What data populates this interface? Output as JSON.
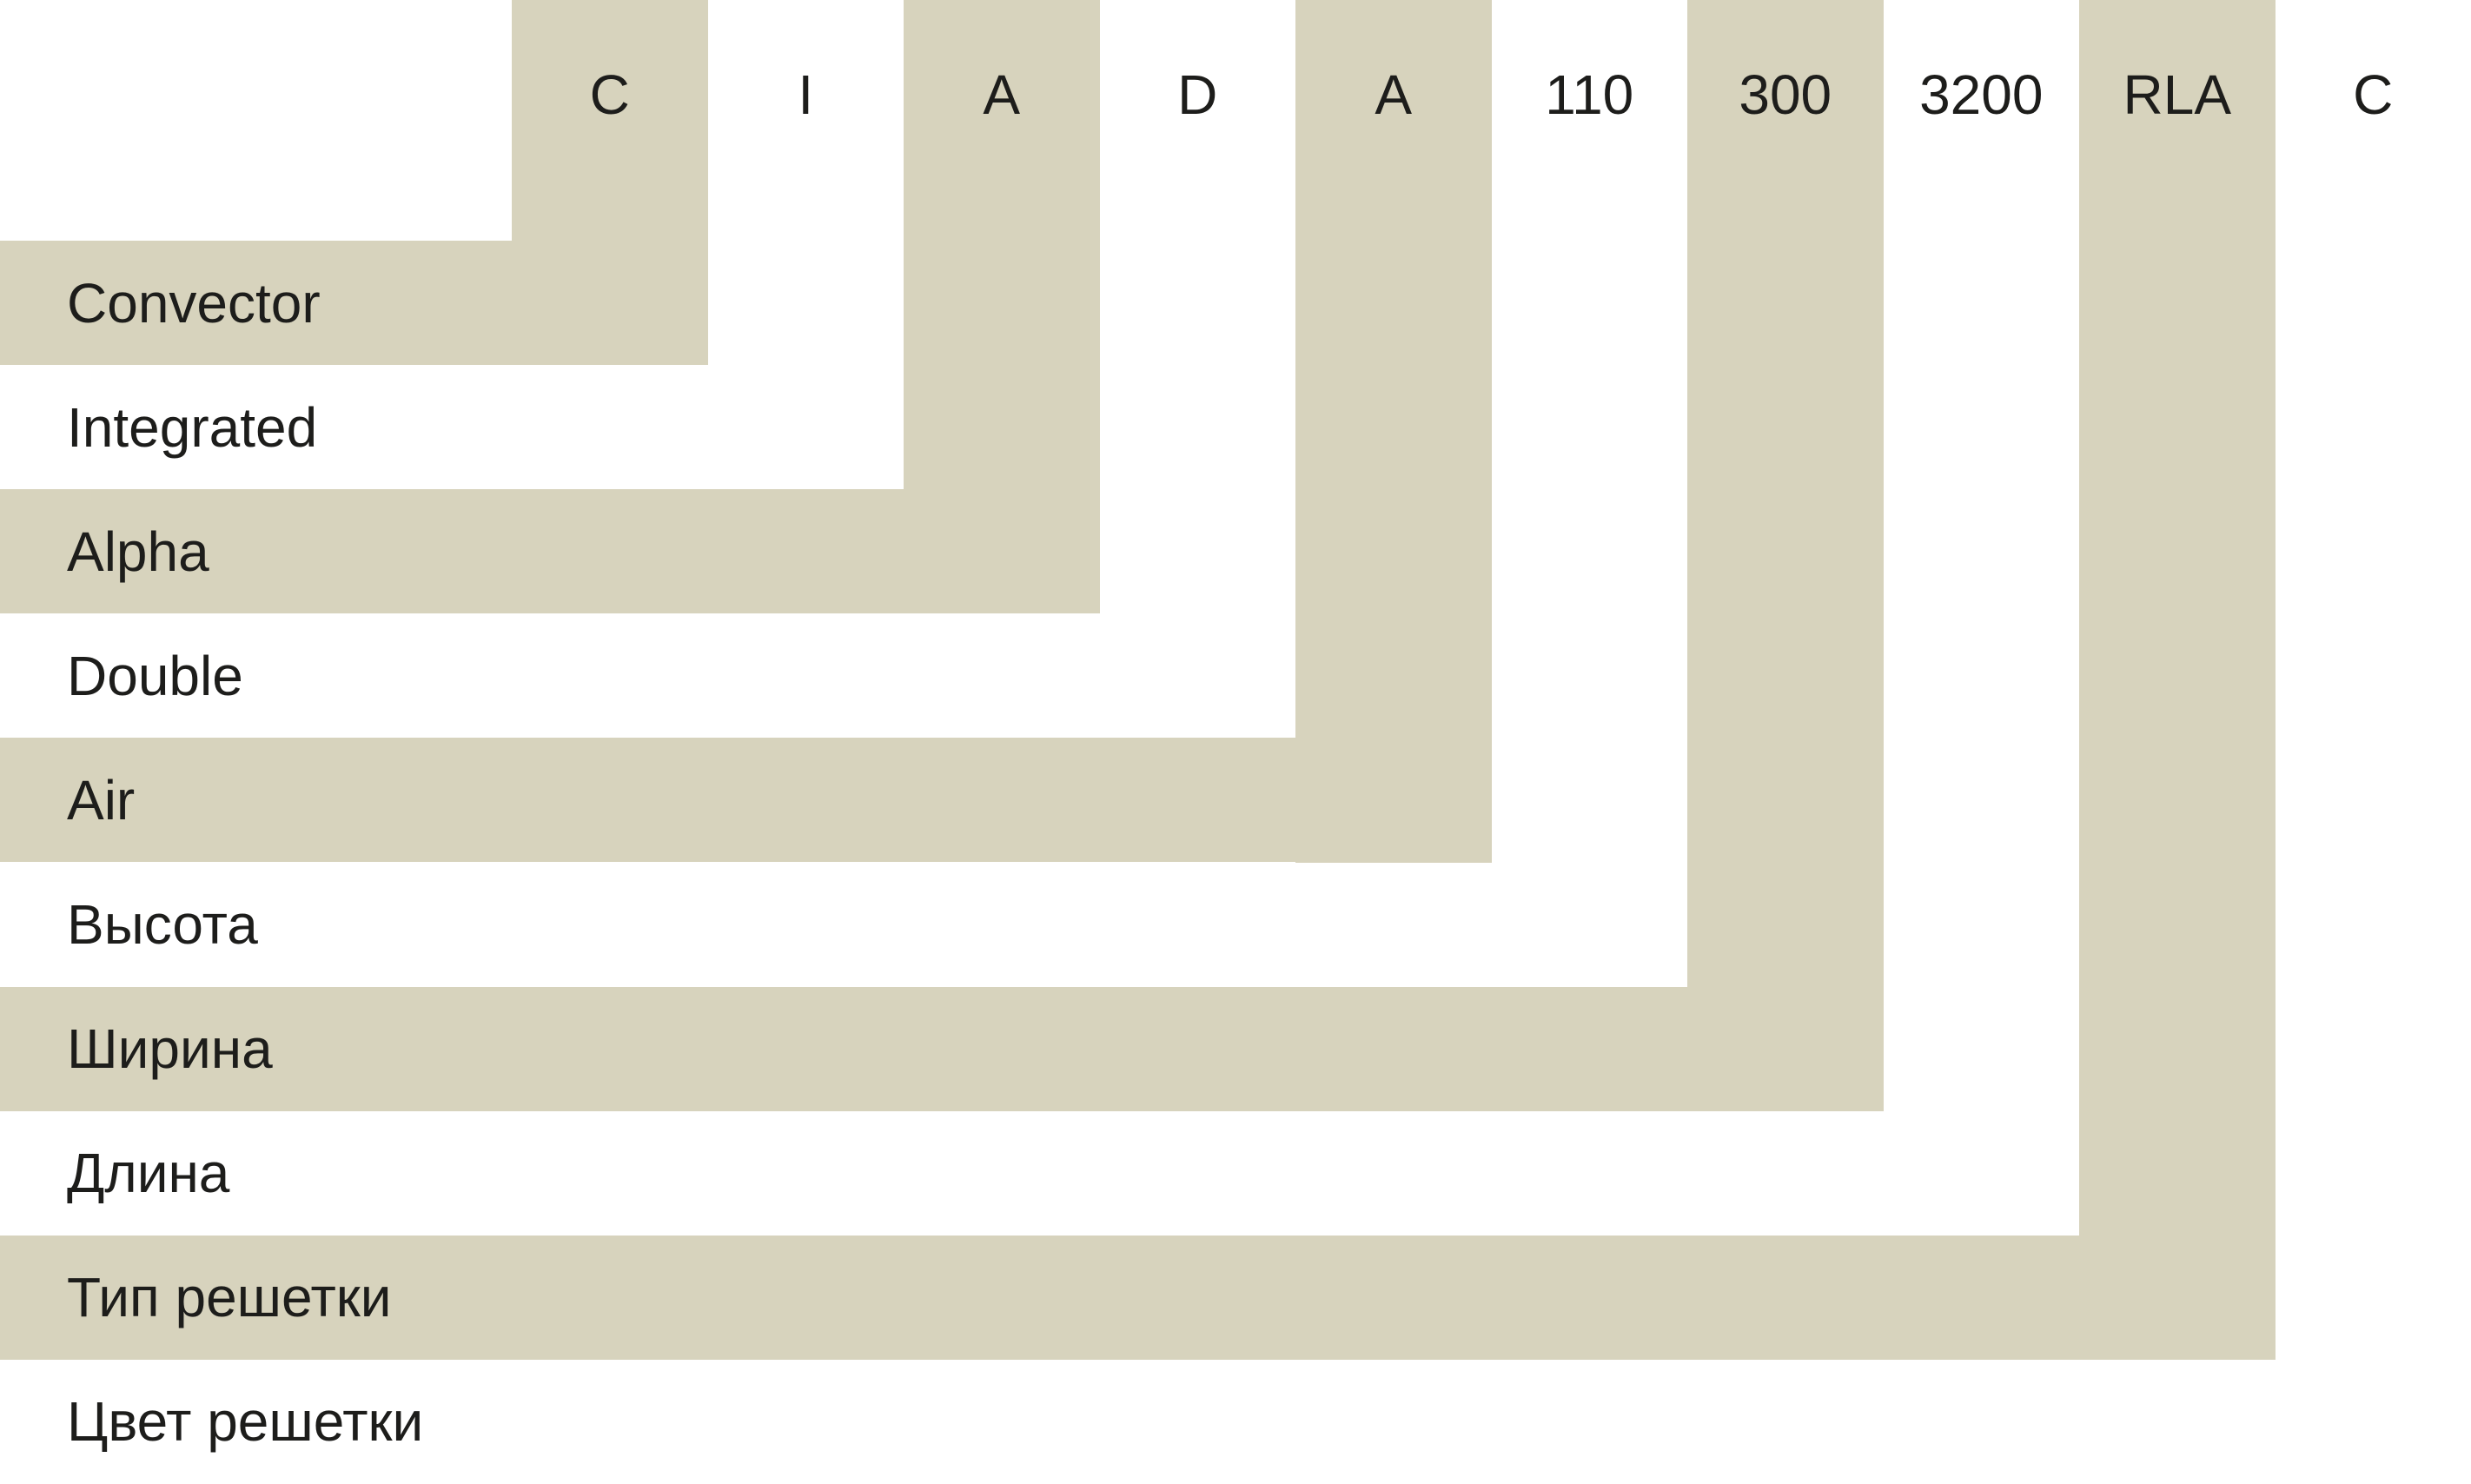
{
  "colors": {
    "band_beige": "#d7d3bd",
    "band_white": "#ffffff",
    "background": "#ffffff",
    "text": "#1d1d1b"
  },
  "bands": [
    {
      "code": "C",
      "label": "Convector",
      "tone": "beige"
    },
    {
      "code": "I",
      "label": "Integrated",
      "tone": "white"
    },
    {
      "code": "A",
      "label": "Alpha",
      "tone": "beige"
    },
    {
      "code": "D",
      "label": "Double",
      "tone": "white"
    },
    {
      "code": "A",
      "label": "Air",
      "tone": "beige"
    },
    {
      "code": "110",
      "label": "Высота",
      "tone": "white"
    },
    {
      "code": "300",
      "label": "Ширина",
      "tone": "beige"
    },
    {
      "code": "3200",
      "label": "Длина",
      "tone": "white"
    },
    {
      "code": "RLA",
      "label": "Тип решетки",
      "tone": "beige"
    },
    {
      "code": "C",
      "label": "Цвет решетки",
      "tone": "white"
    }
  ]
}
